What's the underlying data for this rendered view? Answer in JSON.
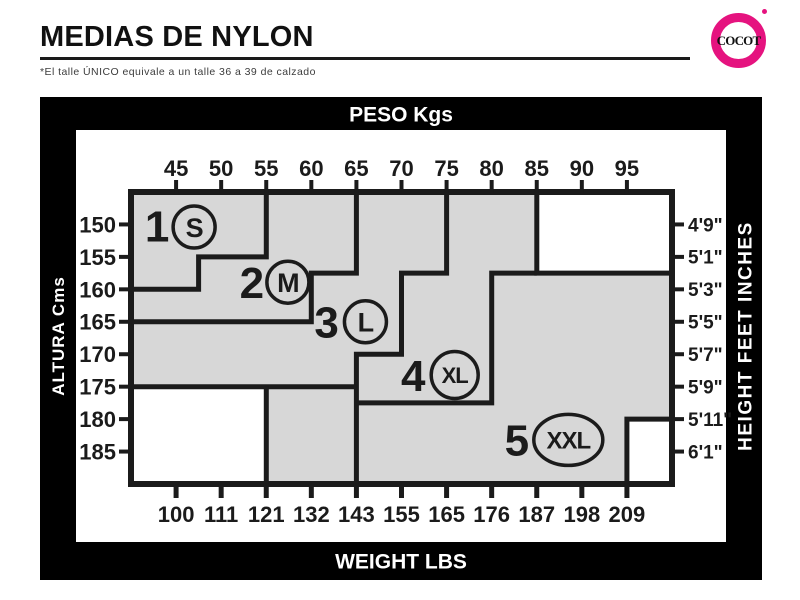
{
  "header": {
    "title": "MEDIAS DE NYLON",
    "footnote": "*El talle ÚNICO equivale a un talle 36 a 39 de calzado",
    "logo_text": "COCOT",
    "logo_color": "#e5137f"
  },
  "chart_data": {
    "type": "step-region-size-chart",
    "title_top": "PESO Kgs",
    "title_bottom": "WEIGHT LBS",
    "title_left": "ALTURA Cms",
    "title_right": "HEIGHT FEET INCHES",
    "x_domain_kg": [
      40,
      100
    ],
    "y_domain_cm": [
      145,
      190
    ],
    "x_ticks_kg": [
      45,
      50,
      55,
      60,
      65,
      70,
      75,
      80,
      85,
      90,
      95
    ],
    "x_ticks_lbs": [
      100,
      111,
      121,
      132,
      143,
      155,
      165,
      176,
      187,
      198,
      209
    ],
    "y_ticks_cm": [
      150,
      155,
      160,
      165,
      170,
      175,
      180,
      185
    ],
    "y_ticks_ftin": [
      "4'9\"",
      "5'1\"",
      "5'3\"",
      "5'5\"",
      "5'7\"",
      "5'9\"",
      "5'11\"",
      "6'1\""
    ],
    "region_fill": "#d7d7d7",
    "line_color": "#1b1b1b",
    "white_cutouts": [
      {
        "name": "top-right",
        "x1": 85,
        "y1": 145,
        "x2": 100,
        "y2": 157.5
      },
      {
        "name": "bottom-left",
        "x1": 40,
        "y1": 175,
        "x2": 55,
        "y2": 190
      },
      {
        "name": "bottom-right",
        "x1": 95,
        "y1": 180,
        "x2": 100,
        "y2": 190
      }
    ],
    "boundaries": [
      {
        "name": "s-m",
        "points": [
          [
            55,
            145
          ],
          [
            55,
            155
          ],
          [
            47.5,
            155
          ],
          [
            47.5,
            160
          ],
          [
            40,
            160
          ]
        ]
      },
      {
        "name": "m-l",
        "points": [
          [
            65,
            145
          ],
          [
            65,
            157.5
          ],
          [
            60,
            157.5
          ],
          [
            60,
            165
          ],
          [
            40,
            165
          ]
        ]
      },
      {
        "name": "l-xl",
        "points": [
          [
            75,
            145
          ],
          [
            75,
            157.5
          ],
          [
            70,
            157.5
          ],
          [
            70,
            170
          ],
          [
            65,
            170
          ],
          [
            65,
            190
          ]
        ]
      },
      {
        "name": "xl-bottom",
        "points": [
          [
            40,
            175
          ],
          [
            65,
            175
          ]
        ]
      },
      {
        "name": "xl-xxl",
        "points": [
          [
            85,
            157.5
          ],
          [
            80,
            157.5
          ],
          [
            80,
            177.5
          ],
          [
            65,
            177.5
          ]
        ]
      },
      {
        "name": "cutout-top-right-edge",
        "points": [
          [
            85,
            145
          ],
          [
            85,
            157.5
          ],
          [
            100,
            157.5
          ]
        ]
      },
      {
        "name": "cutout-bottom-left-edge",
        "points": [
          [
            55,
            175
          ],
          [
            55,
            190
          ]
        ]
      },
      {
        "name": "cutout-bottom-right-edge",
        "points": [
          [
            95,
            190
          ],
          [
            95,
            180
          ],
          [
            100,
            180
          ]
        ]
      }
    ],
    "sizes": [
      {
        "number": "1",
        "code": "S",
        "badge": "circle",
        "number_pos": [
          42.9,
          150.2
        ],
        "badge_pos": [
          47.0,
          150.4
        ]
      },
      {
        "number": "2",
        "code": "M",
        "badge": "circle",
        "number_pos": [
          53.4,
          158.9
        ],
        "badge_pos": [
          57.4,
          158.9
        ]
      },
      {
        "number": "3",
        "code": "L",
        "badge": "circle",
        "number_pos": [
          61.7,
          165.0
        ],
        "badge_pos": [
          66.0,
          165.0
        ]
      },
      {
        "number": "4",
        "code": "XL",
        "badge": "circle",
        "number_pos": [
          71.3,
          173.2
        ],
        "badge_pos": [
          75.9,
          173.2
        ]
      },
      {
        "number": "5",
        "code": "XXL",
        "badge": "ellipse",
        "number_pos": [
          82.8,
          183.2
        ],
        "badge_pos": [
          88.5,
          183.2
        ]
      }
    ]
  }
}
